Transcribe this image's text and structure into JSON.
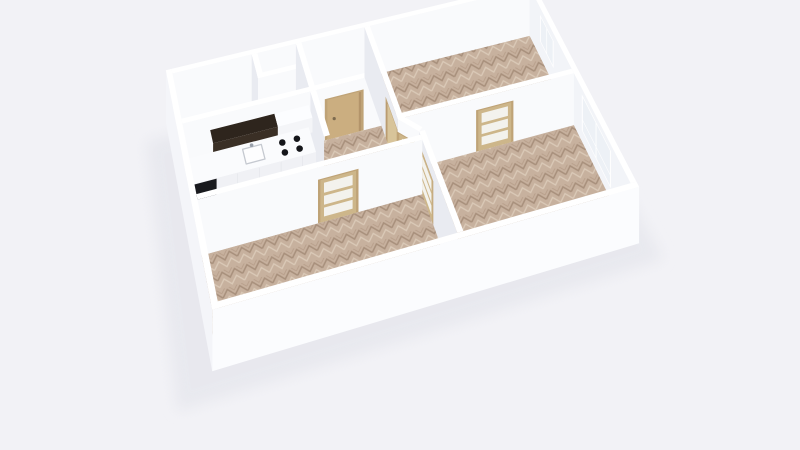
{
  "app": {
    "type": "floorplan-3d-render",
    "description_text": ""
  },
  "scene": {
    "projection": {
      "scale": 40,
      "rotation_deg": -17,
      "y_foreshorten": 0.891,
      "depth_coef": 0.454,
      "z_coef": 0.5,
      "focal": 700,
      "origin_x": 392,
      "origin_y": 180,
      "center_x": 5.0,
      "center_y": 3.2,
      "wall_height": 2.7,
      "wall_thickness": 0.15
    },
    "palette": {
      "background": "#f2f2f6",
      "shadow": "#e2e3ea",
      "floor_light": "#edeff3",
      "parquet_base": "#c7b19e",
      "parquet_dark": "#a8907c",
      "parquet_light": "#dac9b7",
      "wall_bright": "#f9fafc",
      "wall_medium": "#f2f4f8",
      "wall_shaded": "#e9ebf1",
      "wall_exterior": "#f4f5f9",
      "wall_exterior_front": "#fbfcfe",
      "wall_top": "#ffffff",
      "door_frame": "#bfa377",
      "door_wood": "#cbae80",
      "door_wood_dark": "#b3946a",
      "door_open": "#d8c49a",
      "glass_door_leaf": "#cdb68a",
      "glass_pane": "#f3f2ed",
      "window_frame": "#ffffff",
      "window_pane": "#edf1f6",
      "counter_top": "#fafbfd",
      "counter_front": "#f0f1f5",
      "counter_seam": "#e2e4e9",
      "cabinet_dark_front": "#3a2f25",
      "cabinet_dark_top": "#2e251d",
      "cabinet_white_front": "#f4f5f8",
      "cabinet_white_top": "#fcfdff",
      "appliance_black": "#191a1e",
      "burner": "#15161a",
      "sink_line": "#c5c9d0",
      "sink_fill": "#fdfdfe",
      "metal": "#9aa1ab"
    },
    "shadow_poly": [
      [
        -0.7,
        0.1
      ],
      [
        10.3,
        0.1
      ],
      [
        10.6,
        6.95
      ],
      [
        -1.0,
        7.05
      ]
    ],
    "rooms": [
      {
        "id": "bathroom",
        "floor": "white",
        "poly": [
          [
            0,
            0
          ],
          [
            2.1,
            0
          ],
          [
            2.1,
            1.6
          ],
          [
            0,
            1.6
          ]
        ]
      },
      {
        "id": "closet-a",
        "floor": "white",
        "poly": [
          [
            2.1,
            0
          ],
          [
            3.3,
            0
          ],
          [
            3.3,
            0.8
          ],
          [
            2.1,
            0.8
          ]
        ]
      },
      {
        "id": "closet-b",
        "floor": "white",
        "poly": [
          [
            2.1,
            0.8
          ],
          [
            3.3,
            0.8
          ],
          [
            3.3,
            1.6
          ],
          [
            2.1,
            1.6
          ]
        ]
      },
      {
        "id": "entry-nook",
        "floor": "white",
        "poly": [
          [
            3.3,
            0
          ],
          [
            5.2,
            0
          ],
          [
            5.2,
            1.6
          ],
          [
            3.3,
            1.6
          ]
        ]
      },
      {
        "id": "kitchen",
        "floor": "white",
        "poly": [
          [
            0,
            1.6
          ],
          [
            3.3,
            1.6
          ],
          [
            3.3,
            3.8
          ],
          [
            0,
            3.8
          ]
        ]
      },
      {
        "id": "hallway",
        "floor": "parquet",
        "poly": [
          [
            3.3,
            1.6
          ],
          [
            5.2,
            1.6
          ],
          [
            5.2,
            3.05
          ],
          [
            5.6,
            3.55
          ],
          [
            5.6,
            3.8
          ],
          [
            3.3,
            3.8
          ]
        ]
      },
      {
        "id": "bedroom-1",
        "floor": "parquet",
        "poly": [
          [
            5.2,
            0
          ],
          [
            10,
            0
          ],
          [
            10,
            3.05
          ],
          [
            5.2,
            3.05
          ]
        ]
      },
      {
        "id": "living-room",
        "floor": "parquet",
        "poly": [
          [
            5.2,
            3.05
          ],
          [
            10,
            3.05
          ],
          [
            10,
            6.4
          ],
          [
            5.6,
            6.4
          ],
          [
            5.6,
            3.55
          ]
        ]
      },
      {
        "id": "bedroom-2",
        "floor": "parquet",
        "poly": [
          [
            0,
            3.8
          ],
          [
            5.6,
            3.8
          ],
          [
            5.6,
            6.4
          ],
          [
            0,
            6.4
          ]
        ]
      }
    ],
    "walls_back": [
      {
        "id": "north-exterior",
        "from": [
          0,
          0
        ],
        "to": [
          10,
          0
        ],
        "shade": "wall_bright",
        "cap": [
          0,
          -1
        ]
      },
      {
        "id": "east-exterior",
        "from": [
          10,
          0
        ],
        "to": [
          10,
          6.4
        ],
        "shade": "wall_medium",
        "cap": [
          1,
          0
        ],
        "openings": [
          {
            "id": "window-bedroom-1",
            "type": "window",
            "s0": 0.75,
            "s1": 1.7,
            "z0": 0.85,
            "z1": 2.3,
            "panes": "2v"
          },
          {
            "id": "window-living-room",
            "type": "window",
            "s0": 3.55,
            "s1": 5.3,
            "z0": 0.55,
            "z1": 2.4,
            "panes": "2x2",
            "z_split": 1.15
          }
        ]
      },
      {
        "id": "bathroom-east",
        "from": [
          2.1,
          0
        ],
        "to": [
          2.1,
          1.6
        ],
        "shade": "wall_shaded",
        "cap": [
          1,
          0
        ]
      },
      {
        "id": "closet-divider",
        "from": [
          2.1,
          0.8
        ],
        "to": [
          3.3,
          0.8
        ],
        "shade": "wall_bright",
        "cap": [
          0,
          -1
        ]
      },
      {
        "id": "closet-east",
        "from": [
          3.3,
          0
        ],
        "to": [
          3.3,
          1.6
        ],
        "shade": "wall_shaded",
        "cap": [
          1,
          0
        ]
      },
      {
        "id": "entry-wall",
        "from": [
          0,
          1.6
        ],
        "to": [
          5.2,
          1.6
        ],
        "shade": "wall_bright",
        "cap": [
          0,
          -1
        ],
        "openings": [
          {
            "id": "entrance-door",
            "type": "wood-door",
            "s0": 3.75,
            "s1": 4.65,
            "z1": 2.05
          }
        ]
      },
      {
        "id": "kitchen-east",
        "from": [
          3.3,
          1.6
        ],
        "to": [
          3.3,
          3.0
        ],
        "shade": "wall_shaded",
        "cap": [
          1,
          0
        ]
      }
    ],
    "kitchen": [
      {
        "id": "kitchen-upper-cabinet-dark",
        "type": "box",
        "x0": 0.7,
        "y0": 1.62,
        "x1": 2.35,
        "y1": 2.02,
        "z0": 1.32,
        "z1": 2.06,
        "front": "cabinet_dark_front",
        "top": "cabinet_dark_top"
      },
      {
        "id": "kitchen-upper-cabinet-white",
        "type": "box",
        "x0": 2.35,
        "y0": 1.62,
        "x1": 3.25,
        "y1": 2.02,
        "z0": 1.32,
        "z1": 2.06,
        "front": "cabinet_white_front",
        "top": "cabinet_white_top"
      },
      {
        "id": "kitchen-counter",
        "type": "box",
        "x0": 0.08,
        "y0": 1.62,
        "x1": 3.25,
        "y1": 2.38,
        "z0": 0,
        "z1": 0.92,
        "front": "counter_front",
        "top": "counter_top"
      },
      {
        "id": "kitchen-appliance-black",
        "type": "front",
        "x0": 0.1,
        "x1": 0.72,
        "y": 2.38,
        "z0": 0.04,
        "z1": 0.9,
        "fill": "appliance_black"
      },
      {
        "id": "kitchen-counter-seams",
        "type": "seams",
        "xs": [
          1.25,
          1.8,
          2.35,
          2.9
        ],
        "y": 2.38,
        "z0": 0.06,
        "z1": 0.88,
        "fill": "counter_seam"
      },
      {
        "id": "kitchen-sink",
        "type": "sink",
        "x0": 1.5,
        "y0": 1.76,
        "x1": 1.98,
        "y1": 2.2,
        "z": 0.92
      },
      {
        "id": "kitchen-cooktop",
        "type": "burners",
        "z": 0.92,
        "r": 0.085,
        "centers": [
          [
            2.5,
            1.86
          ],
          [
            2.88,
            1.86
          ],
          [
            2.5,
            2.16
          ],
          [
            2.88,
            2.16
          ]
        ]
      }
    ],
    "walls_front": [
      {
        "id": "bedroom-1-west",
        "from": [
          5.2,
          0
        ],
        "to": [
          5.2,
          3.05
        ],
        "shade": "wall_shaded",
        "cap": [
          1,
          0
        ],
        "openings": [
          {
            "id": "doorway-bedroom-1",
            "type": "doorway",
            "s0": 2.05,
            "s1": 2.95,
            "z1": 2.05
          }
        ]
      },
      {
        "id": "bedroom-1-south",
        "from": [
          5.2,
          3.05
        ],
        "to": [
          10,
          3.05
        ],
        "shade": "wall_bright",
        "cap": [
          0,
          -1
        ],
        "openings": [
          {
            "id": "glass-door-bedroom-1",
            "type": "glass-door",
            "s0": 2.15,
            "s1": 3.05,
            "z1": 2.05
          }
        ]
      },
      {
        "id": "hallway-diagonal",
        "from": [
          5.2,
          3.05
        ],
        "to": [
          5.6,
          3.55
        ],
        "shade": "wall_bright",
        "cap": [
          0.78,
          -0.62
        ],
        "openings": [
          {
            "id": "glass-door-hallway",
            "type": "glass-door",
            "s0": 0.04,
            "s1": 0.6,
            "z1": 2.0
          }
        ]
      },
      {
        "id": "living-room-west",
        "from": [
          5.6,
          3.55
        ],
        "to": [
          5.6,
          6.4
        ],
        "shade": "wall_shaded",
        "cap": [
          1,
          0
        ],
        "openings": [
          {
            "id": "glass-door-living-room",
            "type": "glass-door",
            "s0": 0.15,
            "s1": 1.05,
            "z1": 2.05
          }
        ]
      },
      {
        "id": "bedroom-2-north",
        "from": [
          0,
          3.8
        ],
        "to": [
          5.6,
          3.8
        ],
        "shade": "wall_bright",
        "cap": [
          0,
          -1
        ],
        "openings": [
          {
            "id": "glass-door-bedroom-2",
            "type": "glass-door",
            "s0": 3.0,
            "s1": 3.9,
            "z1": 2.05
          }
        ]
      },
      {
        "id": "west-exterior",
        "from": [
          -0.15,
          -0.15
        ],
        "to": [
          -0.15,
          6.55
        ],
        "shade": "wall_exterior",
        "cap": [
          1,
          0
        ]
      },
      {
        "id": "south-exterior",
        "from": [
          -0.15,
          6.55
        ],
        "to": [
          10.15,
          6.55
        ],
        "shade": "wall_exterior_front",
        "cap": [
          0,
          -1
        ]
      }
    ]
  }
}
